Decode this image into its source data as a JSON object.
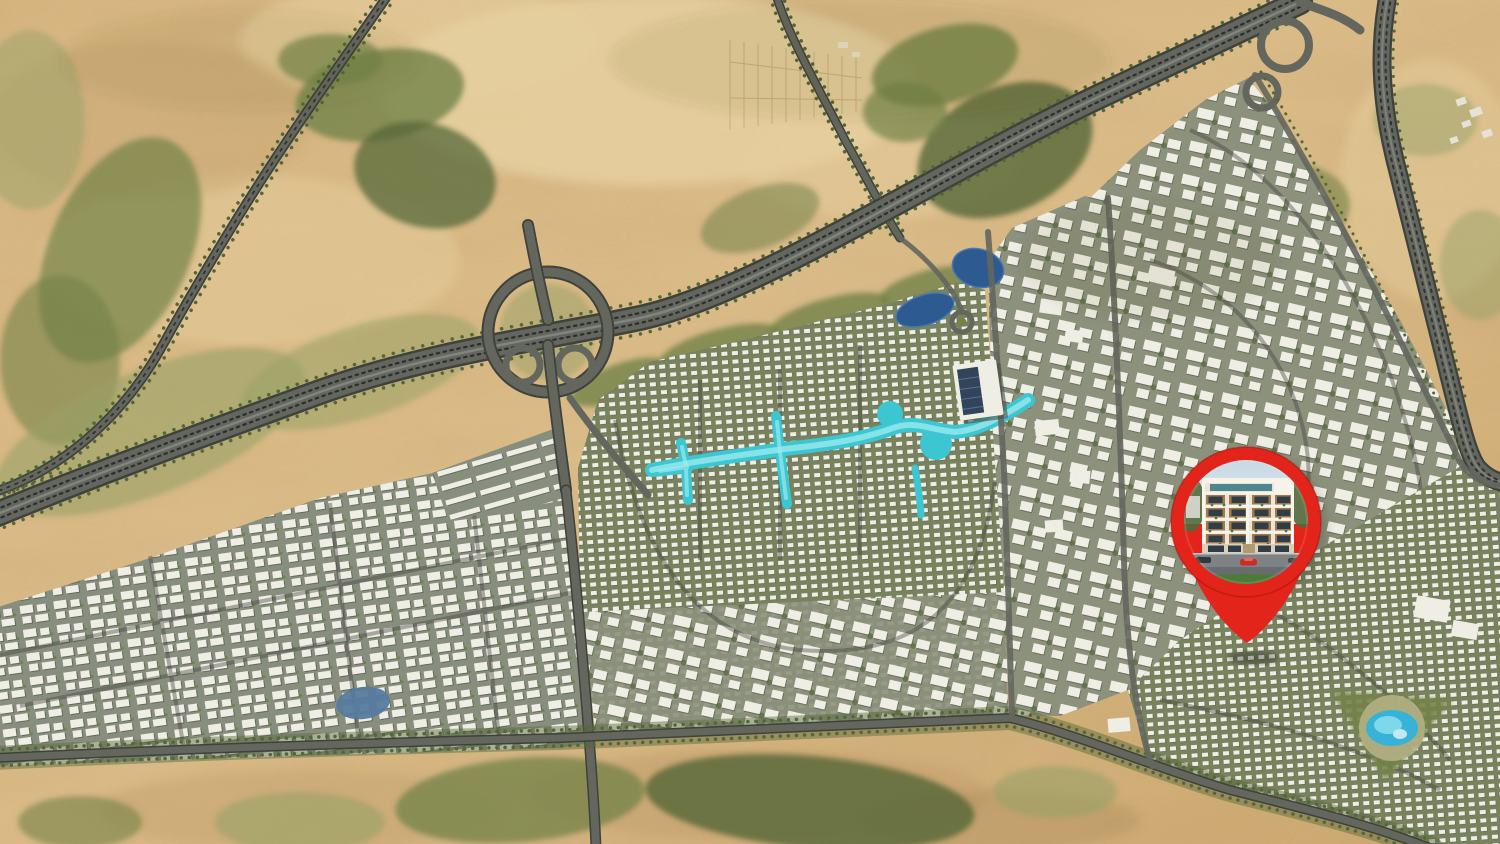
{
  "map": {
    "kind": "aerial-3d-masterplan-location-map",
    "features": [
      "desert-terrain",
      "vegetation-patches",
      "main-highway",
      "highway-loop-interchange",
      "cloverleaf-interchange",
      "right-side-highway",
      "tree-lined-roads",
      "grid-apartment-district",
      "villa-district",
      "crystal-lagoon",
      "central-district",
      "ponds",
      "roundabout",
      "solar-roof-building",
      "curvy-apartment-district",
      "dense-villa-district",
      "water-park",
      "tree-lined-boulevard",
      "small-lake",
      "desert-structures"
    ]
  },
  "marker": {
    "icon": "location-pin-icon",
    "photo": "apartment-building-photo",
    "photo_contents": [
      "sky",
      "low-rise-building",
      "wood-balconies",
      "balcony-plants",
      "storefront",
      "street",
      "red-car",
      "dark-car",
      "green-verge"
    ],
    "color": "#e3241a"
  },
  "colors": {
    "sand1": "#d9b67f",
    "sand2": "#e9d2a2",
    "sand3": "#c6a36f",
    "sandShade": "#9a7d50",
    "veg1": "#55683a",
    "veg2": "#74844a",
    "veg3": "#9aa468",
    "vegPale": "#b6b286",
    "road": "#65685f",
    "roadDark": "#3f423d",
    "roadLight": "#989b93",
    "traffic": "#22252a",
    "base1": "#8a9080",
    "base2": "#7a8460",
    "base3": "#8e937e",
    "bldg": "#f2f1e8",
    "bldgSh": "#4a5046",
    "lagoon": "#3cc9d6",
    "lagoonLight": "#9beef0",
    "lagoonDeep": "#1aa6bb",
    "pond": "#2d5b92",
    "pool": "#38b5da",
    "deck": "#e8dfc3",
    "pinRed": "#e3241a",
    "pinDeep": "#9e130c",
    "sky": "#c7d9e4",
    "facade": "#ece5d6",
    "facadeLight": "#f6f3ea",
    "wood": "#a07a4e",
    "glass": "#313d46",
    "teal": "#3d7a86",
    "asphalt": "#7e8285",
    "asphaltDark": "#686c6f",
    "grass": "#4d7a39",
    "carRed": "#c92e24",
    "carDark": "#32373c",
    "hut": "#e9e5d9"
  }
}
